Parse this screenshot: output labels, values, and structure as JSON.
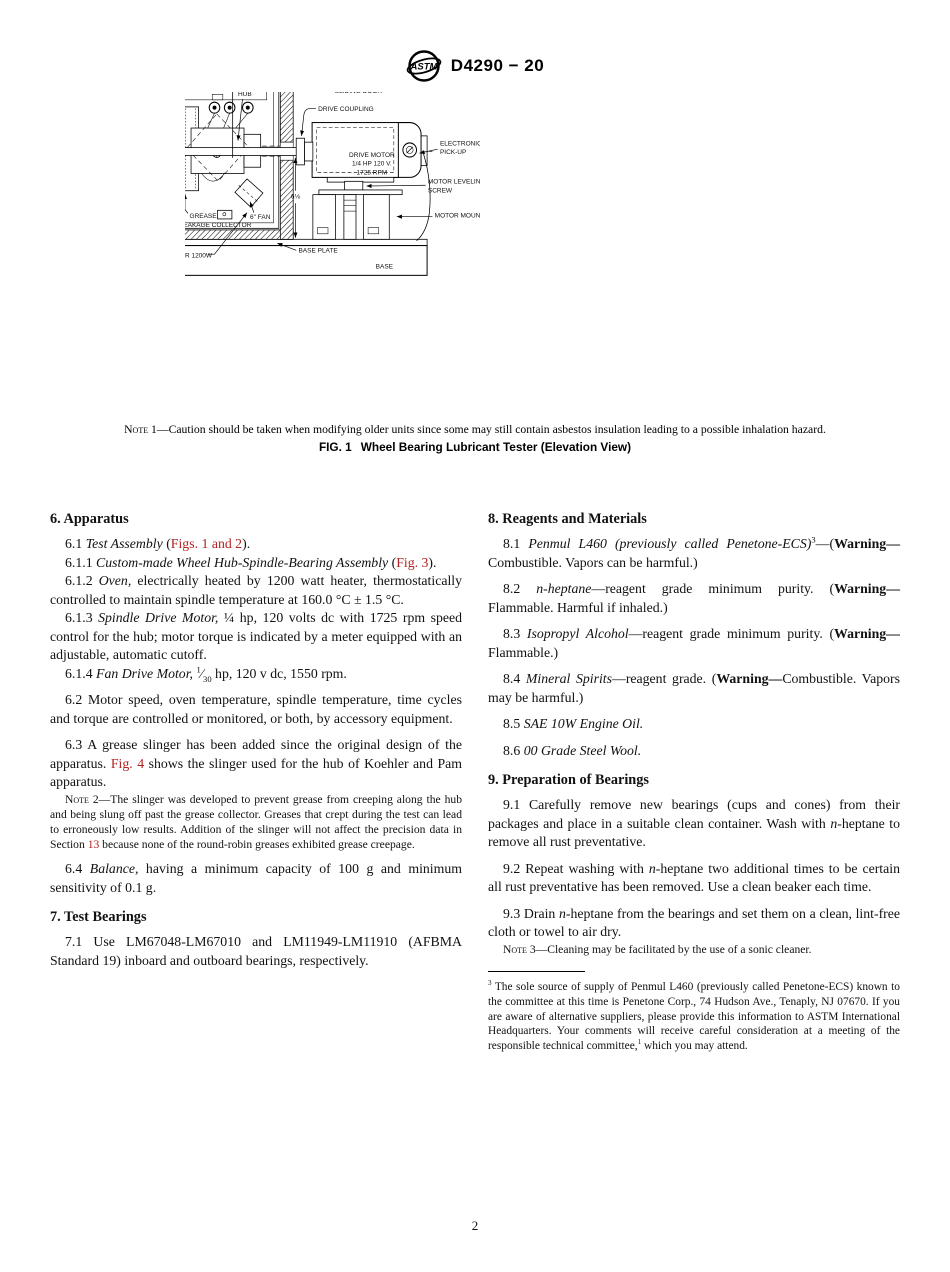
{
  "header": {
    "title": "D4290 − 20",
    "logo_text": "ASTM"
  },
  "figure": {
    "caption_label": "FIG. 1",
    "caption_title": "Wheel Bearing Lubricant Tester (Elevation View)",
    "note1": [
      {
        "t": "Note",
        "s": "sc"
      },
      {
        "t": " 1—Caution should be taken when modifying older units since some may still contain asbestos insulation leading to a possible inhalation hazard."
      }
    ],
    "labels": {
      "dim_width": "8¾",
      "dim_height": "12½",
      "dim_side": "6⅛",
      "thermometer_ferrule": [
        "THERMOMETER",
        "FERRULE"
      ],
      "probe": "PROBE",
      "transite_insulation": "TRANSITE INSULATION",
      "sliding_door": "SLIDING DOOR",
      "drive_coupling": "DRIVE COUPLING",
      "hub": "HUB",
      "tc_well": "TC WELL",
      "bearing_thrust": [
        "BEARING THRUST",
        "LOADING DEVICE"
      ],
      "grease_collector": [
        "GREASE",
        "LEAKAGE COLLECTOR"
      ],
      "fan": "6\" FAN",
      "drive_motor": [
        "DRIVE MOTOR",
        "1/4 HP 120 V.",
        "1725 RPM"
      ],
      "electronic_pickup": [
        "ELECTRONIC",
        "PICK-UP"
      ],
      "motor_leveling": [
        "MOTOR LEVELING",
        "SCREW"
      ],
      "motor_mount": "MOTOR MOUNT",
      "heater": "HEATER 1200W",
      "base_plate": "BASE PLATE",
      "base": "BASE"
    }
  },
  "columns": {
    "left": [
      {
        "type": "h",
        "segs": [
          {
            "t": "6. Apparatus"
          }
        ]
      },
      {
        "type": "p",
        "segs": [
          {
            "t": "6.1 "
          },
          {
            "t": "Test Assembly",
            "s": "i"
          },
          {
            "t": " ("
          },
          {
            "t": "Figs. 1 and 2",
            "s": "link"
          },
          {
            "t": ")."
          }
        ]
      },
      {
        "type": "p",
        "segs": [
          {
            "t": "6.1.1 "
          },
          {
            "t": "Custom-made Wheel Hub-Spindle-Bearing Assembly",
            "s": "i"
          },
          {
            "t": " ("
          },
          {
            "t": "Fig. 3",
            "s": "link"
          },
          {
            "t": ")."
          }
        ]
      },
      {
        "type": "p",
        "segs": [
          {
            "t": "6.1.2 "
          },
          {
            "t": "Oven,",
            "s": "i"
          },
          {
            "t": " electrically heated by 1200 watt heater, thermostatically controlled to maintain spindle temperature at 160.0 °C ± 1.5 °C."
          }
        ]
      },
      {
        "type": "p",
        "segs": [
          {
            "t": "6.1.3 "
          },
          {
            "t": "Spindle Drive Motor,",
            "s": "i"
          },
          {
            "t": " ¼ hp, 120 volts dc with 1725 rpm speed control for the hub; motor torque is indicated by a meter equipped with an adjustable, automatic cutoff."
          }
        ]
      },
      {
        "type": "p",
        "segs": [
          {
            "t": "6.1.4 "
          },
          {
            "t": "Fan Drive Motor,",
            "s": "i"
          },
          {
            "t": " "
          },
          {
            "t": "1",
            "s": "sup"
          },
          {
            "t": "⁄"
          },
          {
            "t": "30",
            "s": "sub"
          },
          {
            "t": " hp, 120 v dc, 1550 rpm."
          }
        ]
      },
      {
        "type": "p gap",
        "segs": [
          {
            "t": "6.2 Motor speed, oven temperature, spindle temperature, time cycles and torque are controlled or monitored, or both, by accessory equipment."
          }
        ]
      },
      {
        "type": "p gap",
        "segs": [
          {
            "t": "6.3 A grease slinger has been added since the original design of the apparatus. "
          },
          {
            "t": "Fig. 4",
            "s": "link"
          },
          {
            "t": " shows the slinger used for the hub of Koehler and Pam apparatus."
          }
        ]
      },
      {
        "type": "note gap",
        "segs": [
          {
            "t": "Note",
            "s": "sc"
          },
          {
            "t": " 2—The slinger was developed to prevent grease from creeping along the hub and being slung off past the grease collector. Greases that crept during the test can lead to erroneously low results. Addition of the slinger will not affect the precision data in Section "
          },
          {
            "t": "13",
            "s": "link"
          },
          {
            "t": " because none of the round-robin greases exhibited grease creepage."
          }
        ]
      },
      {
        "type": "p gap",
        "segs": [
          {
            "t": "6.4 "
          },
          {
            "t": "Balance,",
            "s": "i"
          },
          {
            "t": " having a minimum capacity of 100 g and minimum sensitivity of 0.1 g."
          }
        ]
      },
      {
        "type": "h",
        "segs": [
          {
            "t": "7. Test Bearings"
          }
        ]
      },
      {
        "type": "p",
        "segs": [
          {
            "t": "7.1 Use LM67048-LM67010 and LM11949-LM11910 (AFBMA Standard 19) inboard and outboard bearings, respectively."
          }
        ]
      }
    ],
    "right": [
      {
        "type": "h",
        "segs": [
          {
            "t": "8. Reagents and Materials"
          }
        ]
      },
      {
        "type": "p",
        "segs": [
          {
            "t": "8.1 "
          },
          {
            "t": "Penmul L460 (previously called Penetone-ECS)",
            "s": "i"
          },
          {
            "t": "3",
            "s": "sup"
          },
          {
            "t": "—("
          },
          {
            "t": "Warning—",
            "s": "b"
          },
          {
            "t": "Combustible. Vapors can be harmful.)"
          }
        ]
      },
      {
        "type": "p gap",
        "segs": [
          {
            "t": "8.2 "
          },
          {
            "t": "n-heptane",
            "s": "i"
          },
          {
            "t": "—reagent grade minimum purity. ("
          },
          {
            "t": "Warning—",
            "s": "b"
          },
          {
            "t": "Flammable. Harmful if inhaled.)"
          }
        ]
      },
      {
        "type": "p gap",
        "segs": [
          {
            "t": "8.3 "
          },
          {
            "t": "Isopropyl Alcohol",
            "s": "i"
          },
          {
            "t": "—reagent grade minimum purity. ("
          },
          {
            "t": "Warning—",
            "s": "b"
          },
          {
            "t": "Flammable.)"
          }
        ]
      },
      {
        "type": "p gap",
        "segs": [
          {
            "t": "8.4 "
          },
          {
            "t": "Mineral Spirits",
            "s": "i"
          },
          {
            "t": "—reagent grade. ("
          },
          {
            "t": "Warning—",
            "s": "b"
          },
          {
            "t": "Combustible. Vapors may be harmful.)"
          }
        ]
      },
      {
        "type": "p gap",
        "segs": [
          {
            "t": "8.5 "
          },
          {
            "t": "SAE 10W Engine Oil.",
            "s": "i"
          }
        ]
      },
      {
        "type": "p gap",
        "segs": [
          {
            "t": "8.6 "
          },
          {
            "t": "00 Grade Steel Wool.",
            "s": "i"
          }
        ]
      },
      {
        "type": "h",
        "segs": [
          {
            "t": "9. Preparation of Bearings"
          }
        ]
      },
      {
        "type": "p",
        "segs": [
          {
            "t": "9.1 Carefully remove new bearings (cups and cones) from their packages and place in a suitable clean container. Wash with "
          },
          {
            "t": "n",
            "s": "i"
          },
          {
            "t": "-heptane to remove all rust preventative."
          }
        ]
      },
      {
        "type": "p gap",
        "segs": [
          {
            "t": "9.2 Repeat washing with "
          },
          {
            "t": "n",
            "s": "i"
          },
          {
            "t": "-heptane two additional times to be certain all rust preventative has been removed. Use a clean beaker each time."
          }
        ]
      },
      {
        "type": "p gap",
        "segs": [
          {
            "t": "9.3 Drain "
          },
          {
            "t": "n",
            "s": "i"
          },
          {
            "t": "-heptane from the bearings and set them on a clean, lint-free cloth or towel to air dry."
          }
        ]
      },
      {
        "type": "note gap",
        "segs": [
          {
            "t": "Note",
            "s": "sc"
          },
          {
            "t": " 3—Cleaning may be facilitated by the use of a sonic cleaner."
          }
        ]
      },
      {
        "type": "rule"
      },
      {
        "type": "fn",
        "segs": [
          {
            "t": "3",
            "s": "sup"
          },
          {
            "t": " The sole source of supply of Penmul L460 (previously called Penetone-ECS) known to the committee at this time is Penetone Corp., 74 Hudson Ave., Tenaply, NJ 07670. If you are aware of alternative suppliers, please provide this information to ASTM International Headquarters. Your comments will receive careful consideration at a meeting of the responsible technical committee,"
          },
          {
            "t": "1",
            "s": "sup"
          },
          {
            "t": " which you may attend."
          }
        ]
      }
    ]
  },
  "footer": {
    "page_number": "2"
  }
}
